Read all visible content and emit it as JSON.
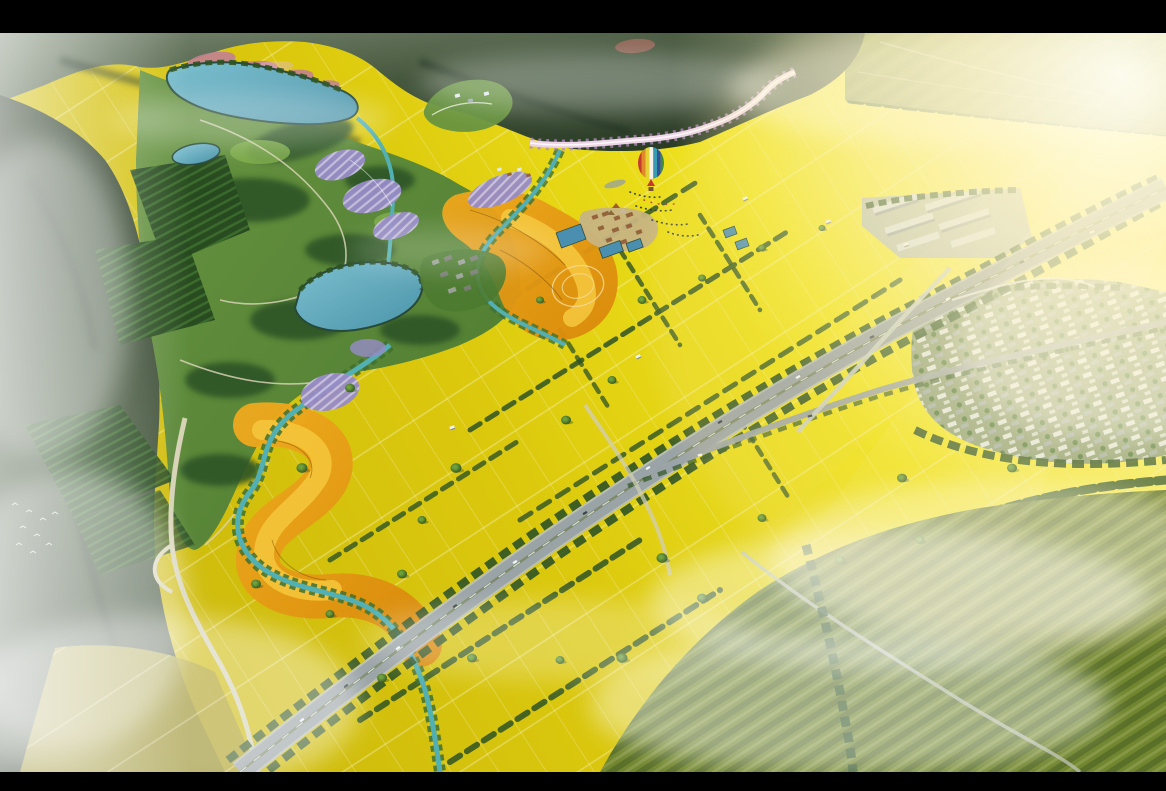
{
  "scene": {
    "type": "aerial-landscape-masterplan-rendering",
    "letterboxed": true
  },
  "colors": {
    "black": "#000000",
    "field_base": "#dcc90d",
    "field_bright": "#f0e41c",
    "field_glow": "#f8f06e",
    "field_dim": "#c9b60c",
    "field_muted": "#a89a22",
    "parcel_line": "#f7f3c4",
    "tree_dark": "#2d5224",
    "tree_mid": "#3f7030",
    "tree_light": "#6fa03b",
    "tree_core": "#24471d",
    "mountain_dark": "#263722",
    "mountain_mid": "#45573d",
    "mountain_haze": "#7c8a74",
    "park_green": "#4d7a30",
    "park_light": "#679440",
    "meadow_light": "#7fae4a",
    "orchard_dark": "#26481f",
    "orchard_stripe": "#3a6a2c",
    "lake_light": "#7cc0cf",
    "lake_deep": "#4a93a9",
    "lake_shore": "#274a3b",
    "stream": "#53b0b2",
    "pond": "#4a8fb0",
    "purple": "#978bc7",
    "purple_light": "#cfc7e6",
    "pink": "#c27f92",
    "pink_light": "#e3b7c9",
    "pink_road": "#eed5e6",
    "pink_fringe": "#b08ac0",
    "orange_deep": "#d9880a",
    "orange_mid": "#eda81d",
    "orange_light": "#f6c93e",
    "orange_contour": "#7a4c08",
    "road_asphalt": "#9aa3a6",
    "road_edge": "#b7bfc2",
    "road_cream": "#d6d2b4",
    "lane_white": "#e8eef0",
    "grass_median": "#7d8a6a",
    "roof_white": "#e4eaea",
    "roof_shadow": "#9fadad",
    "village_base": "#8e9f78",
    "brown_roof": "#95643c",
    "tan_base": "#c7b482",
    "gray_roof": "#787d72",
    "gray_roof_light": "#99a096",
    "market_roof": "#d7dde0",
    "market_shadow": "#97a1a4",
    "market_pad": "#b4bcb9",
    "green_field": "#71862f",
    "green_field_dark": "#5a6f28",
    "green_field_light": "#9aa75c",
    "olive_distant": "#8f9456",
    "fog": "#ffffff",
    "glow_warm": "#ffe9a0",
    "sun_core": "#fffef2",
    "sun_soft": "#fff6cf",
    "car_light": "#f2f5f5",
    "car_dark": "#3a4448",
    "bird": "#eef2ea",
    "balloon_red": "#c63b31",
    "balloon_orange": "#e08b28",
    "balloon_yellow": "#e5d335",
    "balloon_white": "#f2f2ea",
    "balloon_teal": "#3a9ab0",
    "balloon_blue": "#30509b",
    "balloon_green": "#3f8c3f",
    "basket_brown": "#7a5230",
    "people_dark": "#2f3a36",
    "people_red": "#b23b2a",
    "tent_brown": "#a05a28",
    "tent_tan": "#c8b89a",
    "tent_dark": "#8a6a3a",
    "shadow_gray": "#9aa396",
    "shed_white": "#f0f2ee",
    "shed_shadow": "#8a8f85"
  }
}
